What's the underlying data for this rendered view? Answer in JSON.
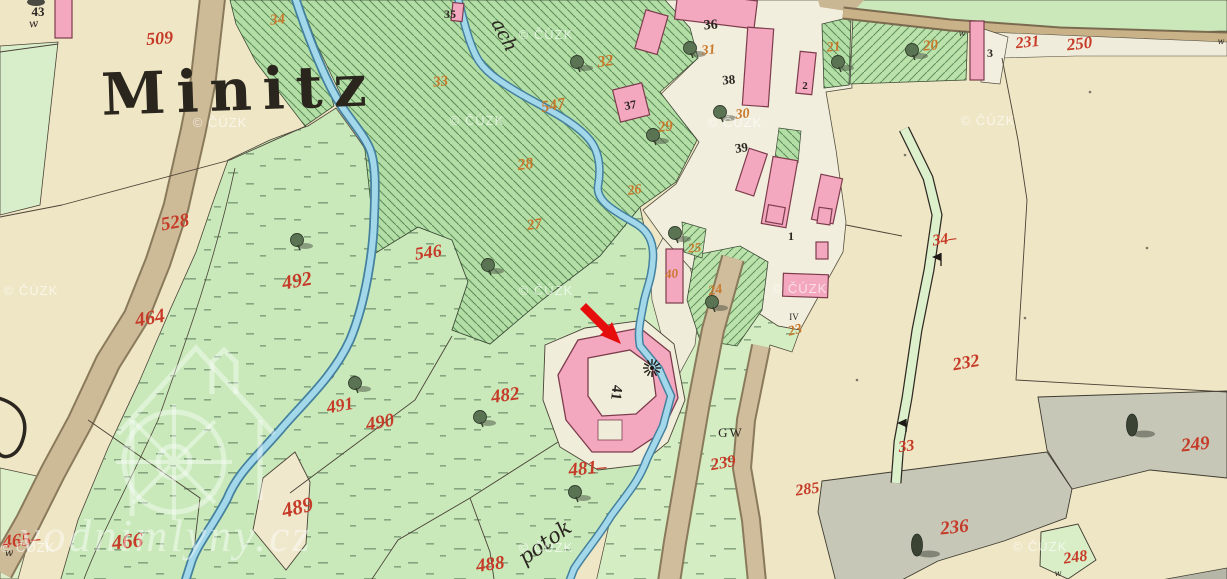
{
  "map": {
    "title": "Minitz",
    "streams": {
      "upper": "ach",
      "lower": "potok"
    },
    "labels_single": {
      "gw": "GW",
      "iv": "IV",
      "mill_parcel": "41"
    },
    "arrow": {
      "color": "#e60d0d",
      "tip_x": 621,
      "tip_y": 344
    },
    "colors": {
      "paper": "#efe6c5",
      "meadow": "#c9e9bb",
      "forest": "#b3dea5",
      "forest_hatch": "#5f8e5c",
      "stream_edge": "#44819e",
      "stream_fill": "#a3d8ea",
      "road": "#cdba97",
      "building": "#f3a8c0",
      "building_outline": "#7d3c4c",
      "gray_area": "#c6c7b6",
      "red_number": "#c63b28",
      "orange_number": "#c8782b",
      "black_number": "#2b2620",
      "arrow_red": "#e60d0d"
    },
    "labels": {
      "red": [
        [
          "509",
          160,
          44,
          18,
          -4
        ],
        [
          "528",
          176,
          228,
          19,
          -10
        ],
        [
          "464",
          151,
          324,
          20,
          -10
        ],
        [
          "492",
          298,
          287,
          20,
          -10
        ],
        [
          "546",
          429,
          258,
          18,
          -8
        ],
        [
          "466",
          128,
          548,
          21,
          -6
        ],
        [
          "465–",
          22,
          546,
          19,
          -6
        ],
        [
          "489",
          299,
          514,
          21,
          -14
        ],
        [
          "490",
          381,
          428,
          19,
          -10
        ],
        [
          "491",
          341,
          411,
          18,
          -10
        ],
        [
          "482",
          506,
          401,
          19,
          -8
        ],
        [
          "481–",
          588,
          474,
          19,
          -6
        ],
        [
          "488",
          491,
          570,
          19,
          -8
        ],
        [
          "231",
          1028,
          47,
          16,
          -6
        ],
        [
          "250",
          1080,
          49,
          17,
          -6
        ],
        [
          "34–",
          945,
          244,
          16,
          -8
        ],
        [
          "232",
          967,
          368,
          18,
          -10
        ],
        [
          "33",
          907,
          451,
          16,
          -8
        ],
        [
          "239",
          724,
          468,
          17,
          -10
        ],
        [
          "285",
          808,
          494,
          16,
          -8
        ],
        [
          "236",
          955,
          533,
          19,
          -6
        ],
        [
          "249",
          1196,
          450,
          19,
          -6
        ],
        [
          "248",
          1076,
          562,
          16,
          -8
        ]
      ],
      "orange": [
        [
          "34",
          278,
          24,
          15,
          -6
        ],
        [
          "33",
          441,
          86,
          15,
          -6
        ],
        [
          "32",
          606,
          66,
          16,
          -8
        ],
        [
          "547",
          554,
          110,
          16,
          -10
        ],
        [
          "28",
          526,
          169,
          16,
          -8
        ],
        [
          "27",
          535,
          229,
          15,
          -8
        ],
        [
          "26",
          635,
          194,
          14,
          -8
        ],
        [
          "29",
          666,
          131,
          15,
          -8
        ],
        [
          "31",
          709,
          54,
          14,
          -6
        ],
        [
          "30",
          743,
          118,
          14,
          -6
        ],
        [
          "25",
          695,
          252,
          13,
          -6
        ],
        [
          "40",
          672,
          278,
          13,
          -6
        ],
        [
          "24",
          716,
          294,
          14,
          -10
        ],
        [
          "23",
          796,
          334,
          14,
          -14
        ],
        [
          "21",
          834,
          51,
          14,
          -6
        ],
        [
          "20",
          931,
          50,
          15,
          -6
        ]
      ],
      "black": [
        [
          "43",
          38,
          16,
          13,
          0
        ],
        [
          "35",
          450,
          18,
          12,
          0
        ],
        [
          "36",
          711,
          29,
          14,
          -4
        ],
        [
          "38",
          729,
          84,
          13,
          -4
        ],
        [
          "39",
          742,
          152,
          13,
          -8
        ],
        [
          "37",
          631,
          109,
          12,
          -10
        ],
        [
          "1",
          791,
          240,
          12,
          0
        ],
        [
          "2",
          805,
          89,
          11,
          0
        ],
        [
          "3",
          990,
          57,
          12,
          0
        ]
      ],
      "scripts": [
        [
          "w",
          34,
          27,
          11,
          -6
        ],
        [
          "w",
          9,
          556,
          10,
          0
        ],
        [
          "w",
          962,
          36,
          8,
          0
        ],
        [
          "w",
          1221,
          44,
          8,
          0
        ],
        [
          "w",
          1058,
          576,
          8,
          0
        ]
      ]
    },
    "watermarks": {
      "text": "© ČÚZK",
      "site": "vodnimlyny.cz",
      "positions": [
        [
          220,
          127
        ],
        [
          477,
          125
        ],
        [
          546,
          39
        ],
        [
          735,
          127
        ],
        [
          988,
          125
        ],
        [
          31,
          295
        ],
        [
          546,
          295
        ],
        [
          800,
          293
        ],
        [
          546,
          552
        ],
        [
          1040,
          551
        ],
        [
          28,
          552
        ]
      ]
    },
    "trees": [
      [
        297,
        240,
        0
      ],
      [
        355,
        383,
        0
      ],
      [
        480,
        417,
        0
      ],
      [
        575,
        492,
        0
      ],
      [
        488,
        265,
        0
      ],
      [
        577,
        62,
        0
      ],
      [
        653,
        135,
        0
      ],
      [
        675,
        233,
        0
      ],
      [
        712,
        302,
        0
      ],
      [
        690,
        48,
        0
      ],
      [
        720,
        112,
        0
      ],
      [
        912,
        50,
        0
      ],
      [
        838,
        62,
        0
      ],
      [
        1132,
        425,
        1
      ],
      [
        917,
        545,
        1
      ]
    ],
    "flags": [
      [
        941,
        266
      ],
      [
        906,
        432
      ]
    ],
    "specks": [
      [
        857,
        380
      ],
      [
        1025,
        318
      ],
      [
        1147,
        248
      ],
      [
        905,
        155
      ],
      [
        1090,
        92
      ]
    ],
    "mill_wheel": {
      "x": 652,
      "y": 368
    }
  }
}
